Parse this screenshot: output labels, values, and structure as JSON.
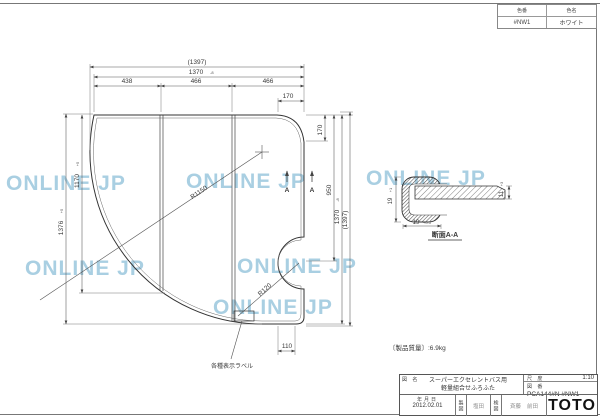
{
  "sheet": {
    "watermark": "ONLINE JP"
  },
  "color_table": {
    "col1_header": "色番",
    "col2_header": "色名",
    "col1_value": "#NW1",
    "col2_value": "ホワイト"
  },
  "plan": {
    "dim_overall_width": "(1397)",
    "dim_width": "1370",
    "dim_width_tol": "-8",
    "dim_seg1": "438",
    "dim_seg2": "466",
    "dim_seg3": "466",
    "dim_corner_width": "170",
    "dim_corner_height": "170",
    "dim_height_950": "950",
    "dim_height": "1370",
    "dim_height_tol": "-8",
    "dim_overall_height": "(1397)",
    "dim_left_height": "1376",
    "dim_left_height_tol": "+5",
    "dim_left_height2": "1170",
    "dim_left_height2_tol": "+5",
    "dim_foot_width": "110",
    "radius_outer": "R1150",
    "radius_notch": "R120",
    "section_cut_label": "A",
    "sticker_note": "各種表示ラベル",
    "weight_note": "〔製品質量〕:6.9kg"
  },
  "section_view": {
    "title": "断面A-A",
    "dim_cap_height": "19",
    "dim_cap_height_tol": "+1",
    "dim_cap_width": "19",
    "dim_cap_width_tol": "+0.5",
    "dim_panel_thickness": "11",
    "dim_panel_thickness_tol": "+3"
  },
  "title_block": {
    "name_label": "図 名",
    "product_name_line1": "スーパーエクセレントバス用",
    "product_name_line2": "軽量組合せふろふた",
    "scale_label": "尺 度",
    "scale_value": "1:10",
    "number_label": "図 番",
    "drawing_number": "PCA144#N #NW1",
    "date_label": "年月日",
    "date_value": "2012.02.01",
    "drafter_label": "製図",
    "drafter_stamp": "塩田",
    "checker_label": "検図",
    "checker_stamp": "斉藤",
    "approver_stamp": "前田",
    "brand": "TOTO"
  }
}
